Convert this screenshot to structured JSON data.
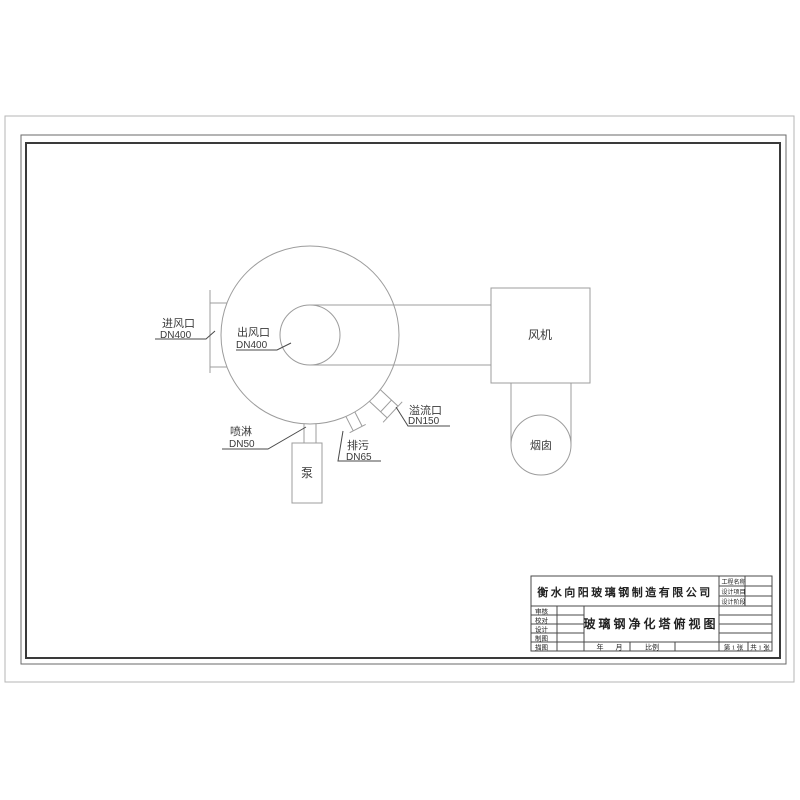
{
  "drawing": {
    "labels": {
      "inlet": {
        "name": "进风口",
        "size": "DN400"
      },
      "outlet": {
        "name": "出风口",
        "size": "DN400"
      },
      "spray": {
        "name": "喷淋",
        "size": "DN50"
      },
      "drain": {
        "name": "排污",
        "size": "DN65"
      },
      "overflow": {
        "name": "溢流口",
        "size": "DN150"
      },
      "fan": "风机",
      "pump": "泵",
      "chimney": "烟囱"
    }
  },
  "title_block": {
    "company": "衡水向阳玻璃钢制造有限公司",
    "drawing_title": "玻璃钢净化塔俯视图",
    "fields_right": [
      "工程名称",
      "设计项目",
      "设计阶段"
    ],
    "fields_left": [
      "审核",
      "校对",
      "设计",
      "制图",
      "描图"
    ],
    "bottom": {
      "date_year": "年",
      "date_month": "月",
      "scale": "比例",
      "sheet_no": "第 1 张",
      "sheet_total": "共 1 张"
    }
  },
  "colors": {
    "paper_border": "#b5b5b5",
    "drawing_line": "#9c9c9c",
    "annotation": "#4a4a4a",
    "frame": "#3a3a3a"
  }
}
